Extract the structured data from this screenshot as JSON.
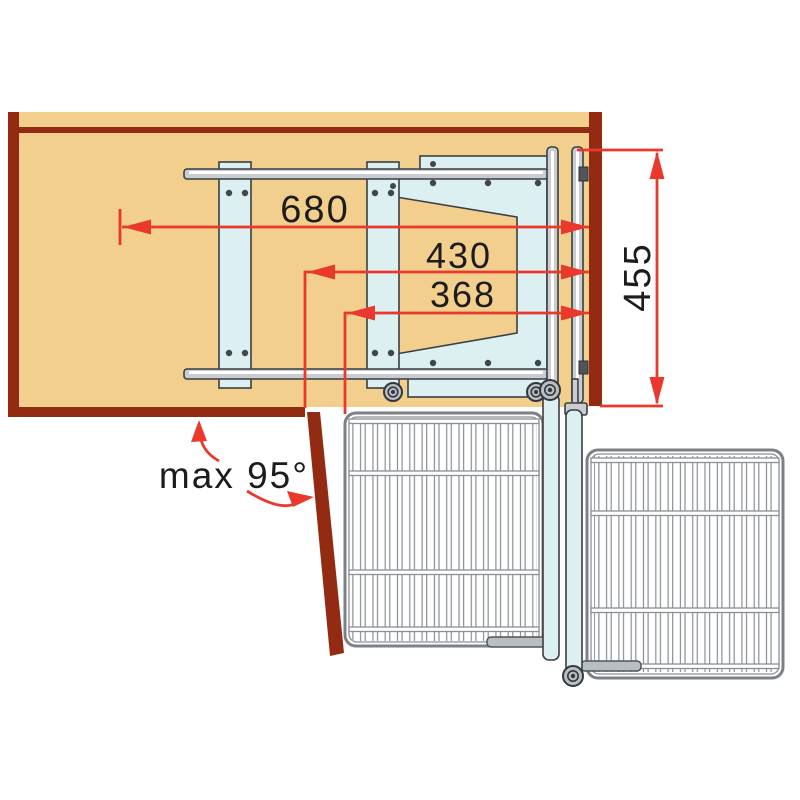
{
  "diagram": {
    "labels": {
      "total_width": "680",
      "pivot_width": "430",
      "basket_width": "368",
      "side_depth": "455",
      "door_opening": "max 95°"
    },
    "colors": {
      "carcass": "#932b12",
      "panel_tan": "#f2cf8d",
      "dimension_red": "#ea392c",
      "mechanism_blue": "#dceff1",
      "rail_gray": "#c9cdd1",
      "wire_gray": "#8a9095",
      "outline": "#3a3f44",
      "text": "#1c1c1c",
      "background": "#ffffff"
    }
  }
}
